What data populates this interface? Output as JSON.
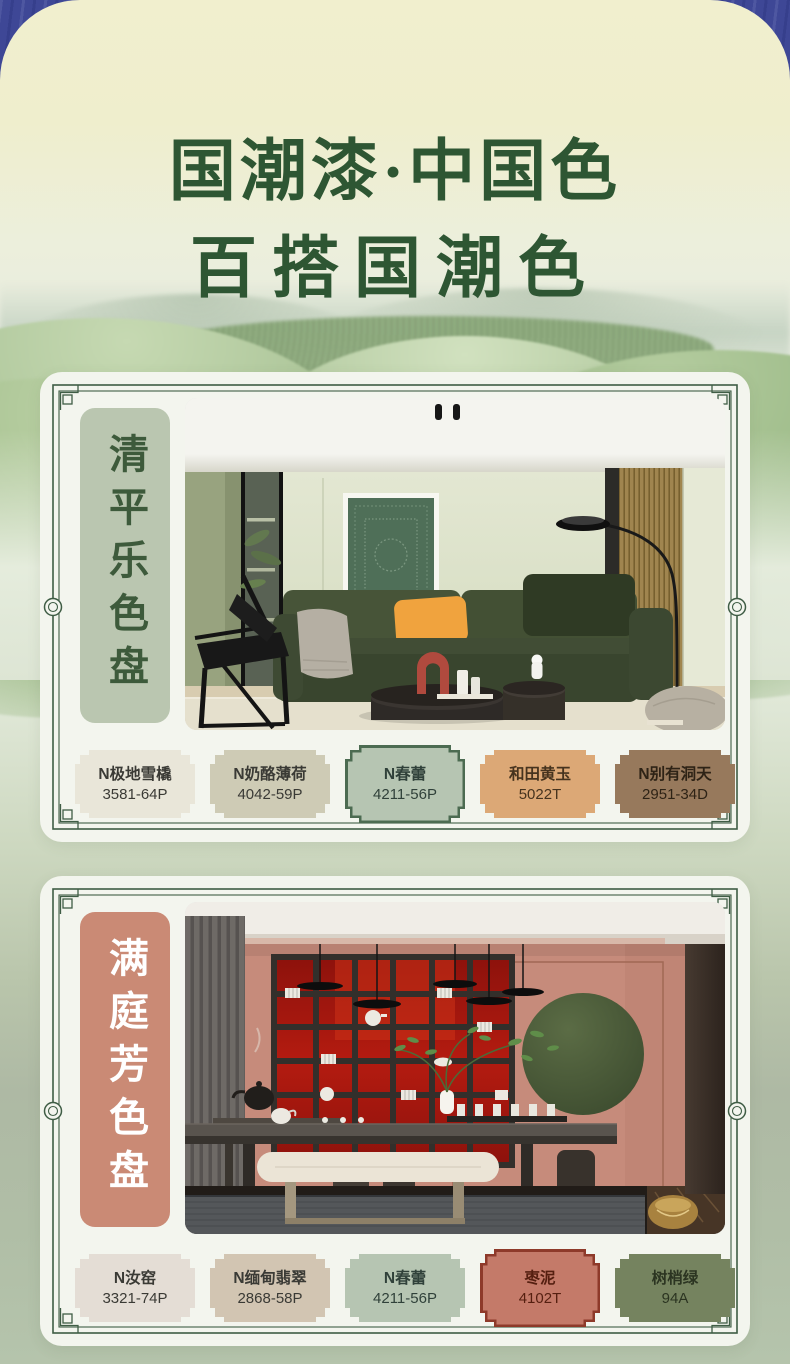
{
  "title": {
    "line1": "国潮漆·中国色",
    "line2": "百搭国潮色"
  },
  "theme": {
    "outer_background": "#3e4796",
    "sheet_top_cream": "#f0eecb",
    "sheet_bottom_green": "#b1bfa7",
    "card_background": "#f3f5ee",
    "frame_line_green": "#3f5d45",
    "title_green": "#2e5633"
  },
  "cards": [
    {
      "name": "清平乐色盘",
      "label_bg": "#bac6b0",
      "label_color": "#3d5a3b",
      "swatches": [
        {
          "name": "N极地雪橇",
          "code": "3581-64P",
          "fill": "#e9e6d9",
          "text": "#3a3a35"
        },
        {
          "name": "N奶酪薄荷",
          "code": "4042-59P",
          "fill": "#cecbb5",
          "text": "#3a3a35"
        },
        {
          "name": "N春蕾",
          "code": "4211-56P",
          "fill": "#b6c5b2",
          "text": "#30413a",
          "border": "#4c6b51"
        },
        {
          "name": "和田黄玉",
          "code": "5022T",
          "fill": "#dca876",
          "text": "#46331e"
        },
        {
          "name": "N别有洞天",
          "code": "2951-34D",
          "fill": "#97795c",
          "text": "#2e2316"
        }
      ]
    },
    {
      "name": "满庭芳色盘",
      "label_bg": "#ca8a75",
      "label_color": "#ffffff",
      "swatches": [
        {
          "name": "N汝窑",
          "code": "3321-74P",
          "fill": "#e4ddd5",
          "text": "#3a3a35"
        },
        {
          "name": "N缅甸翡翠",
          "code": "2868-58P",
          "fill": "#d2c5b2",
          "text": "#3a3a35"
        },
        {
          "name": "N春蕾",
          "code": "4211-56P",
          "fill": "#b6c5b2",
          "text": "#30413a"
        },
        {
          "name": "枣泥",
          "code": "4102T",
          "fill": "#c47a69",
          "text": "#551f10",
          "border": "#8e3a2a"
        },
        {
          "name": "树梢绿",
          "code": "94A",
          "fill": "#75835f",
          "text": "#2b3421"
        }
      ]
    }
  ]
}
